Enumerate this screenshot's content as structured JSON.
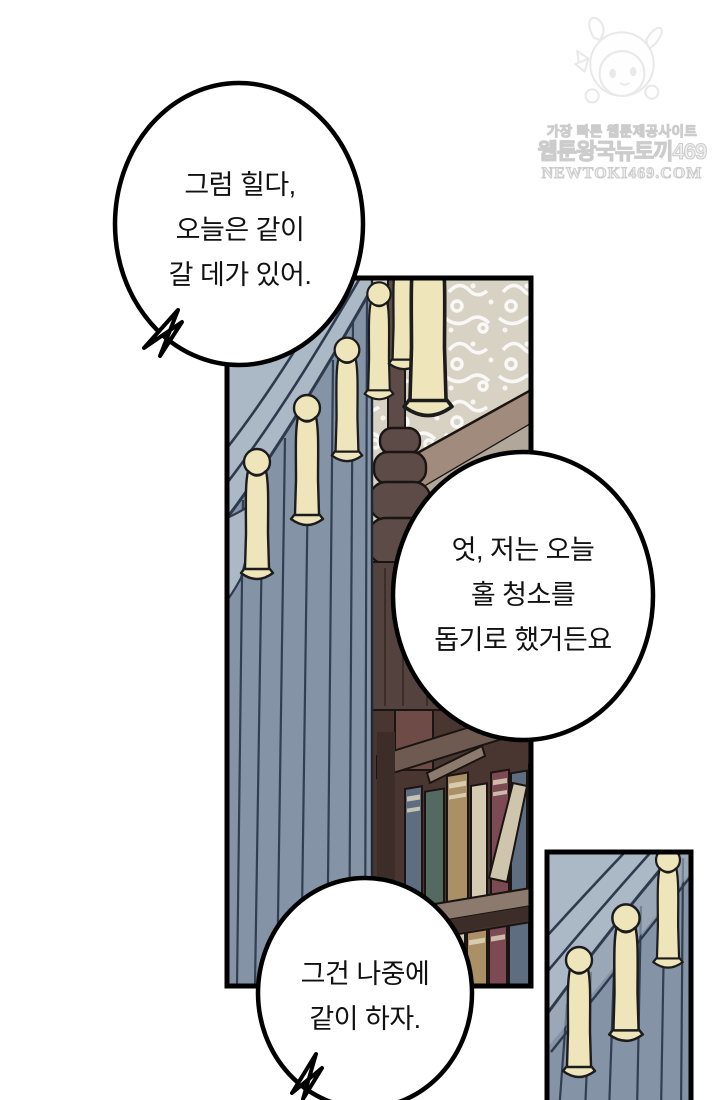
{
  "page": {
    "type": "webtoon-comic-page",
    "background": "#ffffff"
  },
  "watermark": {
    "mascot_icon": "bunny-hood-chibi-mascot",
    "line1": "가장 빠른 웹툰제공사이트",
    "line2": "웹툰왕국뉴토끼469",
    "line3": "NEWTOKI469.COM"
  },
  "bubbles": [
    {
      "position": "top-left",
      "tail": "bottom-left",
      "lines": [
        "그럼 힐다,",
        "오늘은 같이",
        "갈 데가 있어."
      ]
    },
    {
      "position": "middle-right",
      "tail": "none",
      "lines": [
        "엇, 저는 오늘",
        "홀 청소를",
        "돕기로 했거든요"
      ]
    },
    {
      "position": "bottom-center",
      "tail": "bottom-left",
      "lines": [
        "그건 나중에",
        "같이 하자."
      ]
    }
  ],
  "panels": [
    {
      "name": "library-panel",
      "contents": [
        "blue-gray curtain with cream tassels",
        "damask wallpaper",
        "dark wooden column with carved capital",
        "diagonal molding",
        "bookshelf with two rows of books"
      ]
    },
    {
      "name": "curtain-inset-panel",
      "contents": [
        "blue-gray curtain swag",
        "three cream tassels"
      ]
    }
  ],
  "colors": {
    "curtain_main": "#8593a6",
    "curtain_light": "#abb8c5",
    "curtain_line": "#2e3a4e",
    "tassel": "#efe5ba",
    "tassel_line": "#1c1c1c",
    "wallpaper": "#d8d2c4",
    "wood_dark": "#5d4b47",
    "wood_shadow": "#3c2d28",
    "wood_column": "#54423e",
    "molding": "#a18b7c",
    "molding_shade": "#b1a79b",
    "shelf_bg": "#4a3630",
    "shelf_plank": "#8d7a6e",
    "book_slate": "#5f6d81",
    "book_teal": "#54695f",
    "book_tan": "#aa9064",
    "book_cream": "#d5cab2",
    "book_maroon": "#7b4a52",
    "outline": "#1a1512",
    "panel_border": "#000000",
    "bubble_fill": "#ffffff",
    "bubble_stroke": "#000000",
    "text": "#111111",
    "watermark_gray": "#c4c4c4"
  }
}
